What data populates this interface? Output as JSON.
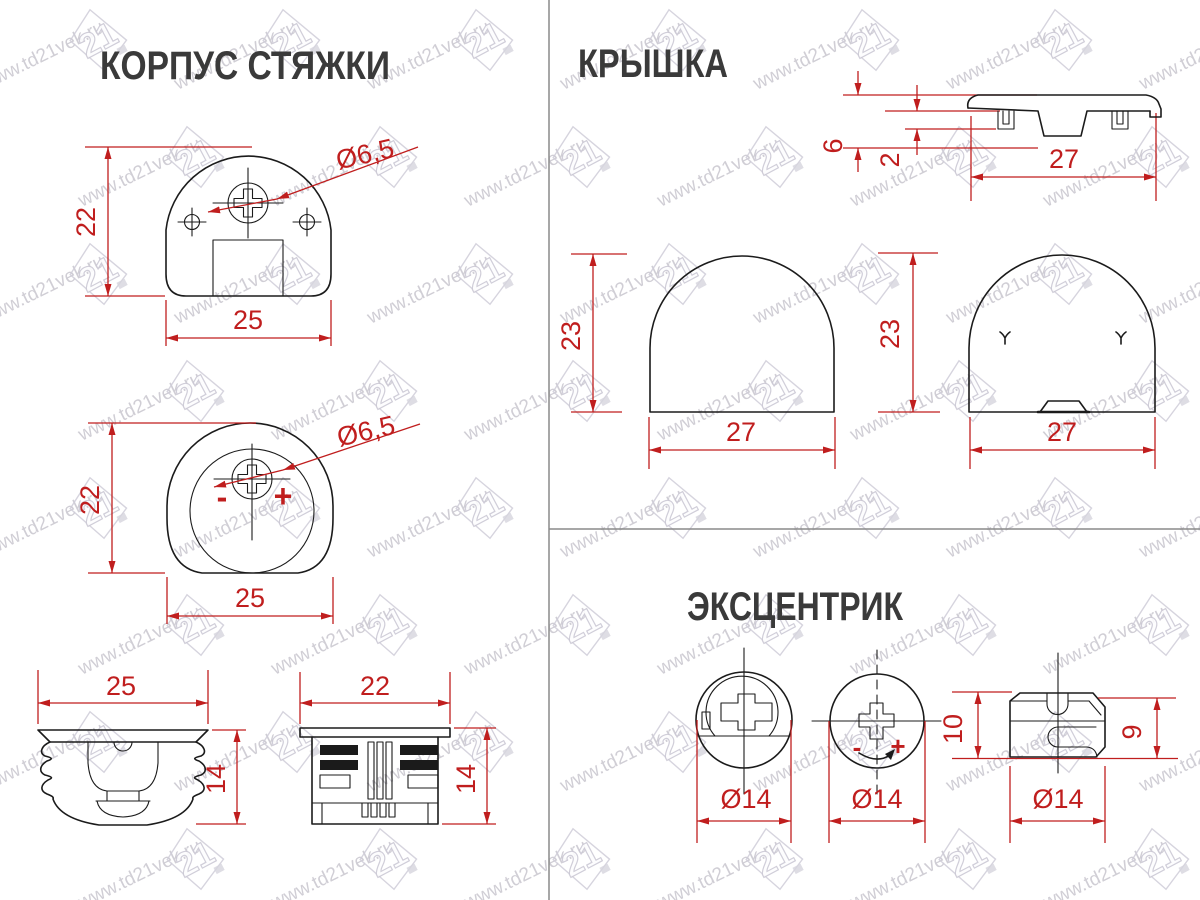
{
  "colors": {
    "red": "#c01e1e",
    "ink": "#1b1b1b",
    "title": "#3a3a3a",
    "watermark": "#aba7b4",
    "divider": "#8a8a8a"
  },
  "watermark": {
    "url": "www.td21vek.ru",
    "logo": "21"
  },
  "sections": {
    "korpus": {
      "title": "КОРПУС СТЯЖКИ",
      "front": {
        "height": "22",
        "width": "25",
        "hole": "Ø6,5"
      },
      "side": {
        "height": "22",
        "width": "25",
        "hole": "Ø6,5",
        "minus": "-",
        "plus": "+"
      },
      "bottom_a": {
        "width": "25",
        "height": "14"
      },
      "bottom_b": {
        "width": "22",
        "height": "14"
      }
    },
    "kryshka": {
      "title": "КРЫШКА",
      "profile": {
        "height": "6",
        "thickness": "2",
        "width": "27"
      },
      "dome_left": {
        "height": "23",
        "width": "27"
      },
      "dome_right": {
        "height": "23",
        "width": "27"
      }
    },
    "excentrik": {
      "title": "ЭКСЦЕНТРИК",
      "face": {
        "dia": "Ø14"
      },
      "back": {
        "dia": "Ø14",
        "minus": "-",
        "plus": "+"
      },
      "side": {
        "height": "10",
        "inner_height": "9",
        "dia": "Ø14"
      }
    }
  }
}
